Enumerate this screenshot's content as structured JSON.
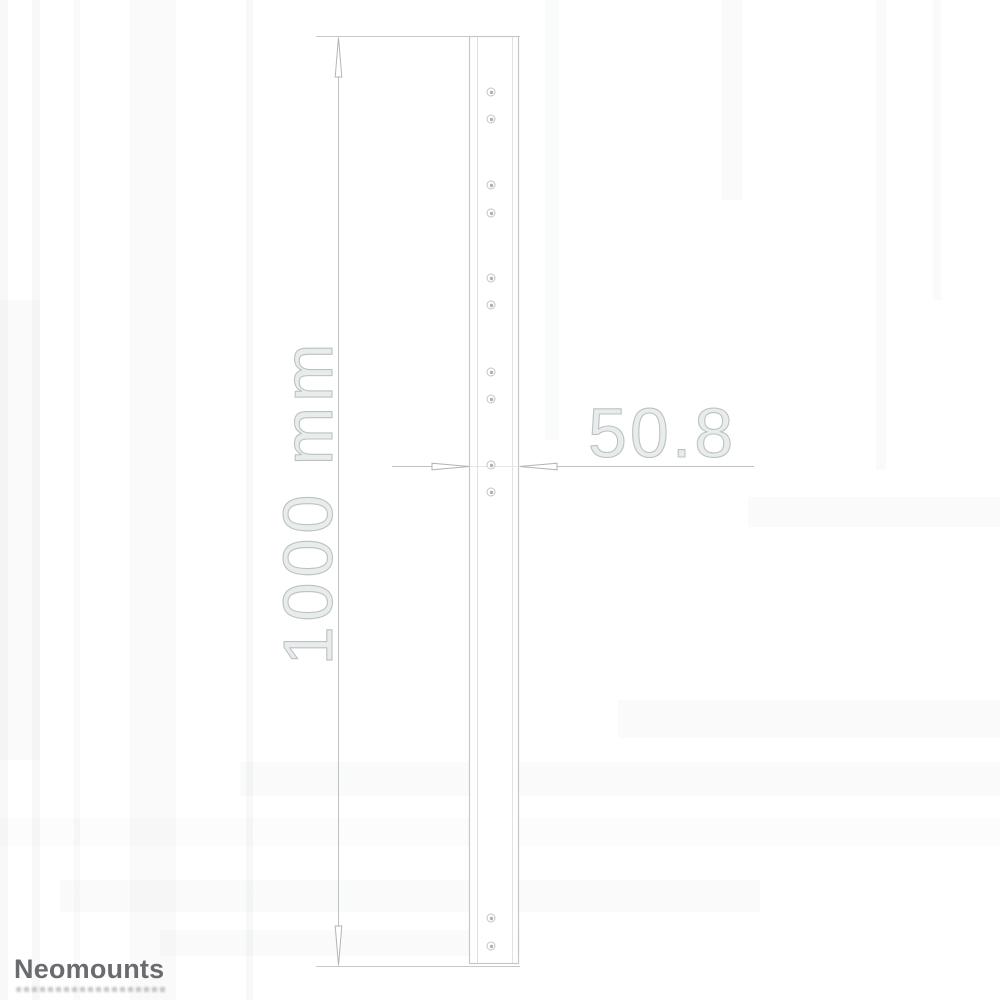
{
  "drawing": {
    "vertical_dimension_label": "1000 mm",
    "horizontal_dimension_label": "50.8",
    "hole_x": 491,
    "holes_y": [
      92,
      119,
      185,
      213,
      278,
      305,
      372,
      399,
      465,
      492,
      918,
      946
    ]
  },
  "branding": {
    "logo_text": "Neomounts"
  },
  "colors": {
    "line": "#c6c8c8",
    "dim_line": "#bfc1c1",
    "dim_text_stroke": "#bcc2c2",
    "logo_text": "#696b6e",
    "background": "#ffffff"
  }
}
